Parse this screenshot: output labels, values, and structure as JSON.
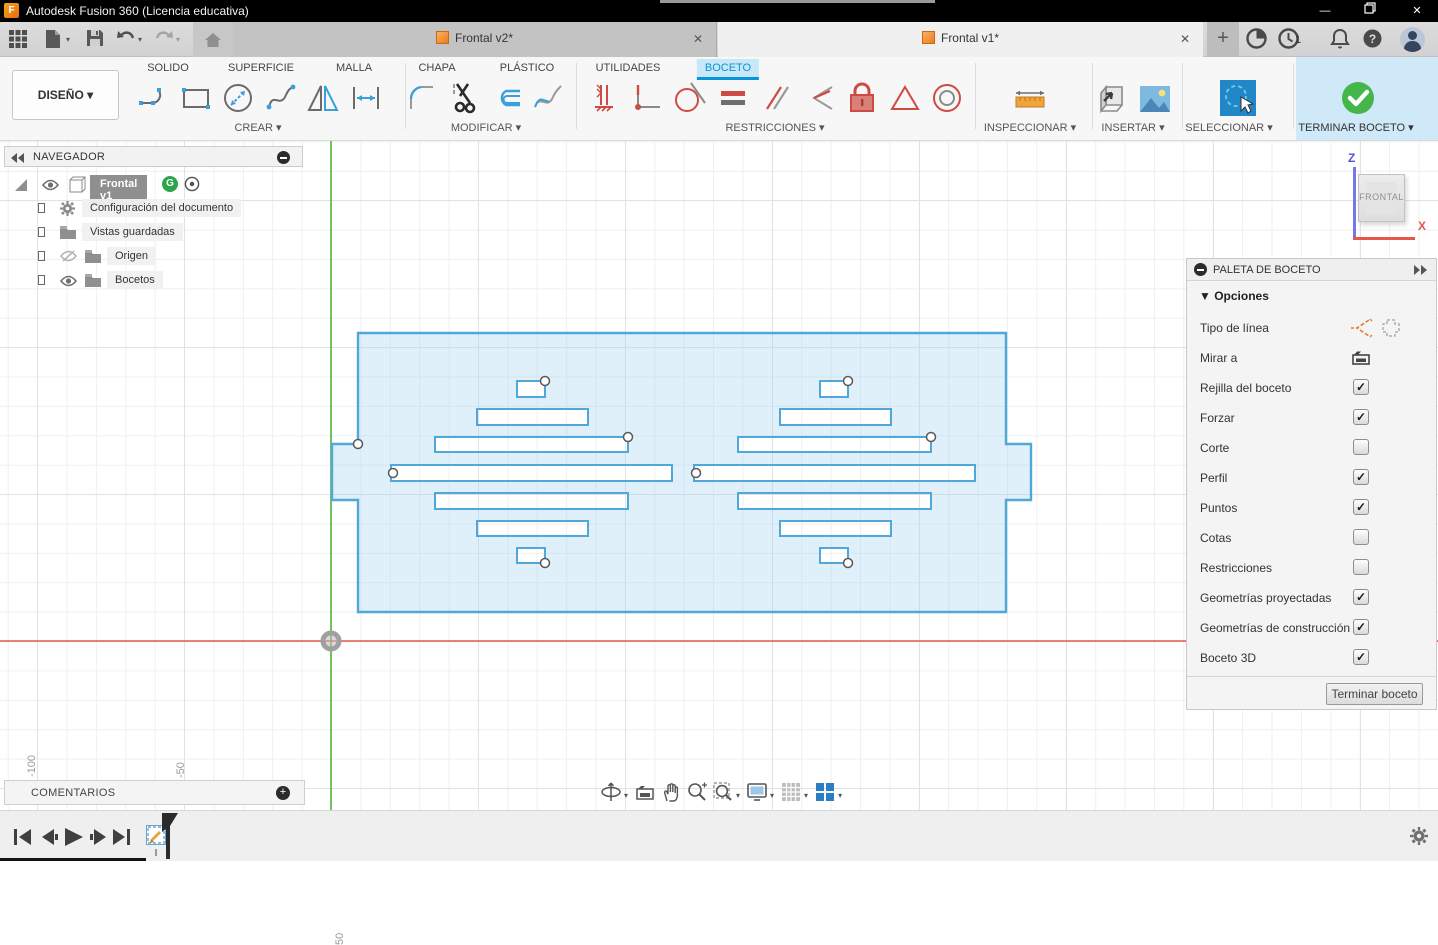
{
  "window": {
    "title": "Autodesk Fusion 360 (Licencia educativa)",
    "app_badge": "F"
  },
  "icons": {
    "caret_down": "▾",
    "close": "✕",
    "minimize": "—",
    "check": "✓",
    "plus": "+",
    "collapse_double_left": "◀◀",
    "expand_double_right": "▶▶",
    "question": "?"
  },
  "doc_tabs": [
    {
      "label": "Frontal v2*",
      "active": false
    },
    {
      "label": "Frontal v1*",
      "active": true
    }
  ],
  "status": {
    "clock_count": "1"
  },
  "ribbon": {
    "design_button": "DISEÑO",
    "tabs": [
      "SOLIDO",
      "SUPERFICIE",
      "MALLA",
      "CHAPA",
      "PLÁSTICO",
      "UTILIDADES",
      "BOCETO"
    ],
    "active_tab": "BOCETO",
    "groups": [
      {
        "label": "CREAR"
      },
      {
        "label": "MODIFICAR"
      },
      {
        "label": "RESTRICCIONES"
      },
      {
        "label": "INSPECCIONAR"
      },
      {
        "label": "INSERTAR"
      },
      {
        "label": "SELECCIONAR"
      },
      {
        "label": "TERMINAR BOCETO"
      }
    ]
  },
  "navigator": {
    "title": "NAVEGADOR",
    "root": "Frontal v1",
    "badge": "G",
    "items": [
      "Configuración del documento",
      "Vistas guardadas",
      "Origen",
      "Bocetos"
    ]
  },
  "palette": {
    "title": "PALETA DE BOCETO",
    "section": "Opciones",
    "rows": [
      {
        "label": "Tipo de línea",
        "type": "icons"
      },
      {
        "label": "Mirar a",
        "type": "icon"
      },
      {
        "label": "Rejilla del boceto",
        "type": "checkbox",
        "checked": true
      },
      {
        "label": "Forzar",
        "type": "checkbox",
        "checked": true
      },
      {
        "label": "Corte",
        "type": "checkbox",
        "checked": false
      },
      {
        "label": "Perfil",
        "type": "checkbox",
        "checked": true
      },
      {
        "label": "Puntos",
        "type": "checkbox",
        "checked": true
      },
      {
        "label": "Cotas",
        "type": "checkbox",
        "checked": false
      },
      {
        "label": "Restricciones",
        "type": "checkbox",
        "checked": false
      },
      {
        "label": "Geometrías proyectadas",
        "type": "checkbox",
        "checked": true
      },
      {
        "label": "Geometrías de construcción",
        "type": "checkbox",
        "checked": true
      },
      {
        "label": "Boceto 3D",
        "type": "checkbox",
        "checked": true
      }
    ],
    "finish_button": "Terminar boceto"
  },
  "viewcube": {
    "face": "FRONTAL",
    "axis_x": "X",
    "axis_z": "Z"
  },
  "canvas": {
    "ruler_labels": [
      "-100",
      "-50",
      "50"
    ]
  },
  "comments": {
    "title": "COMENTARIOS"
  },
  "sketch": {
    "outline_path": "M358,333 H1006 V444 H1031 V500 H1006 V612 H358 V500 H332 V444 H358 Z",
    "slots": [
      [
        517,
        381,
        28,
        16
      ],
      [
        477,
        409,
        111,
        16
      ],
      [
        435,
        437,
        193,
        15
      ],
      [
        391,
        465,
        281,
        16
      ],
      [
        435,
        493,
        193,
        16
      ],
      [
        477,
        521,
        111,
        15
      ],
      [
        517,
        548,
        28,
        15
      ]
    ],
    "right_offset": 303,
    "points": [
      [
        545,
        381
      ],
      [
        628,
        437
      ],
      [
        393,
        473
      ],
      [
        545,
        563
      ],
      [
        358,
        444
      ],
      [
        848,
        381
      ],
      [
        931,
        437
      ],
      [
        696,
        473
      ],
      [
        848,
        563
      ]
    ],
    "fill": "rgba(167,212,241,0.35)",
    "stroke": "#4fa7da",
    "axis_x_color": "#e4584c",
    "axis_y_color": "#52b53a",
    "axis_x_y": 641,
    "axis_y_x": 331
  }
}
